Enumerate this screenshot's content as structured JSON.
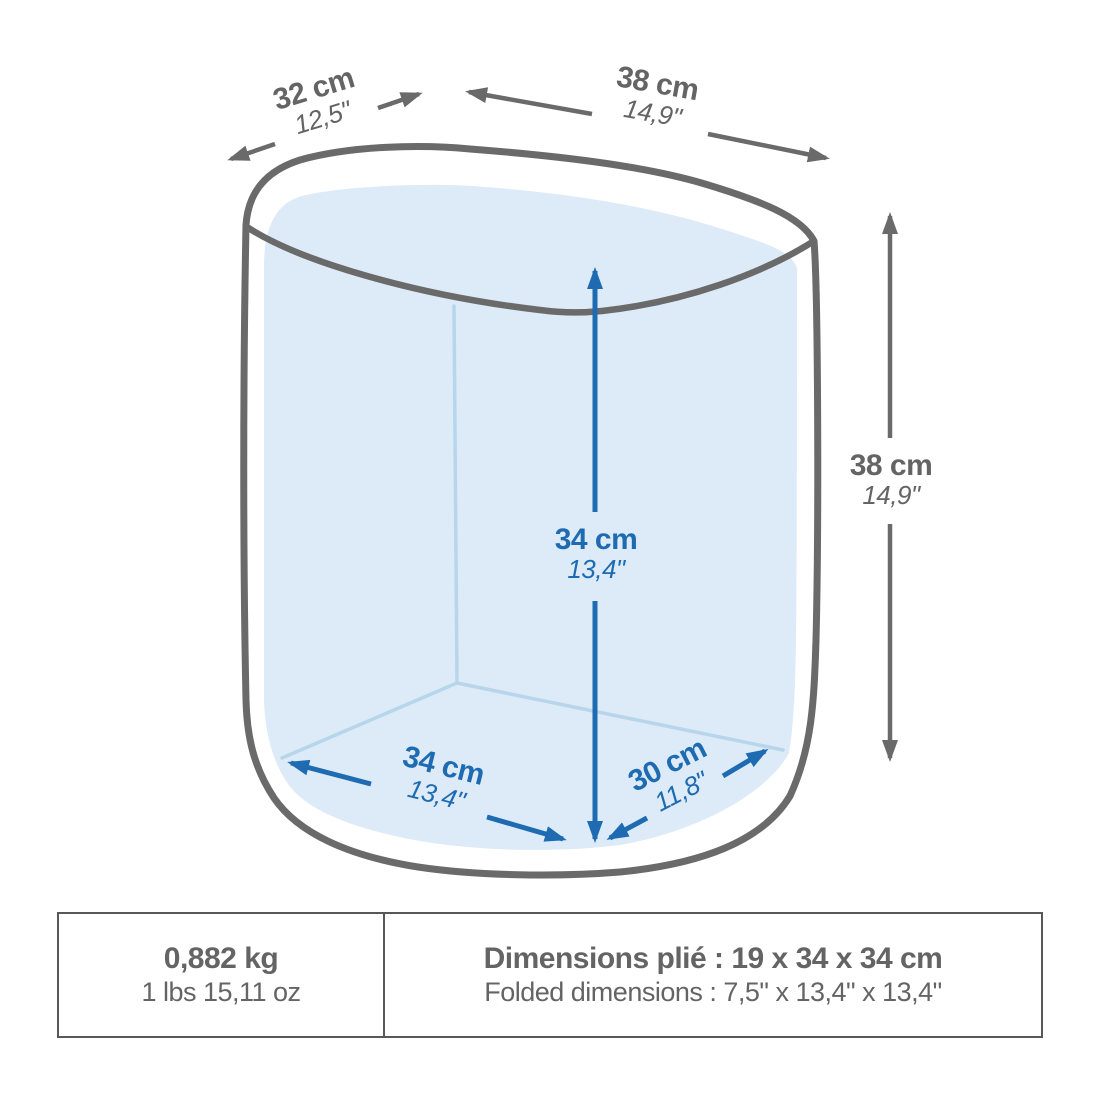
{
  "diagram": {
    "dim_depth_top": {
      "cm": "32 cm",
      "inch": "12,5\""
    },
    "dim_width_top": {
      "cm": "38 cm",
      "inch": "14,9\""
    },
    "dim_height_right": {
      "cm": "38 cm",
      "inch": "14,9\""
    },
    "dim_height_inner": {
      "cm": "34 cm",
      "inch": "13,4\""
    },
    "dim_width_bottom": {
      "cm": "34 cm",
      "inch": "13,4\""
    },
    "dim_depth_bottom": {
      "cm": "30 cm",
      "inch": "11,8\""
    }
  },
  "specs": {
    "weight_kg": "0,882 kg",
    "weight_lbs": "1 lbs 15,11 oz",
    "folded_fr": "Dimensions plié : 19 x 34 x 34 cm",
    "folded_en": "Folded dimensions : 7,5\" x 13,4\" x 13,4\""
  },
  "colors": {
    "outline_gray": "#6a6a6a",
    "label_gray": "#646464",
    "accent_blue": "#1e6bb2",
    "interior_fill": "#dcebf7",
    "interior_edge": "#b7d5eb",
    "table_border": "#57585a"
  }
}
